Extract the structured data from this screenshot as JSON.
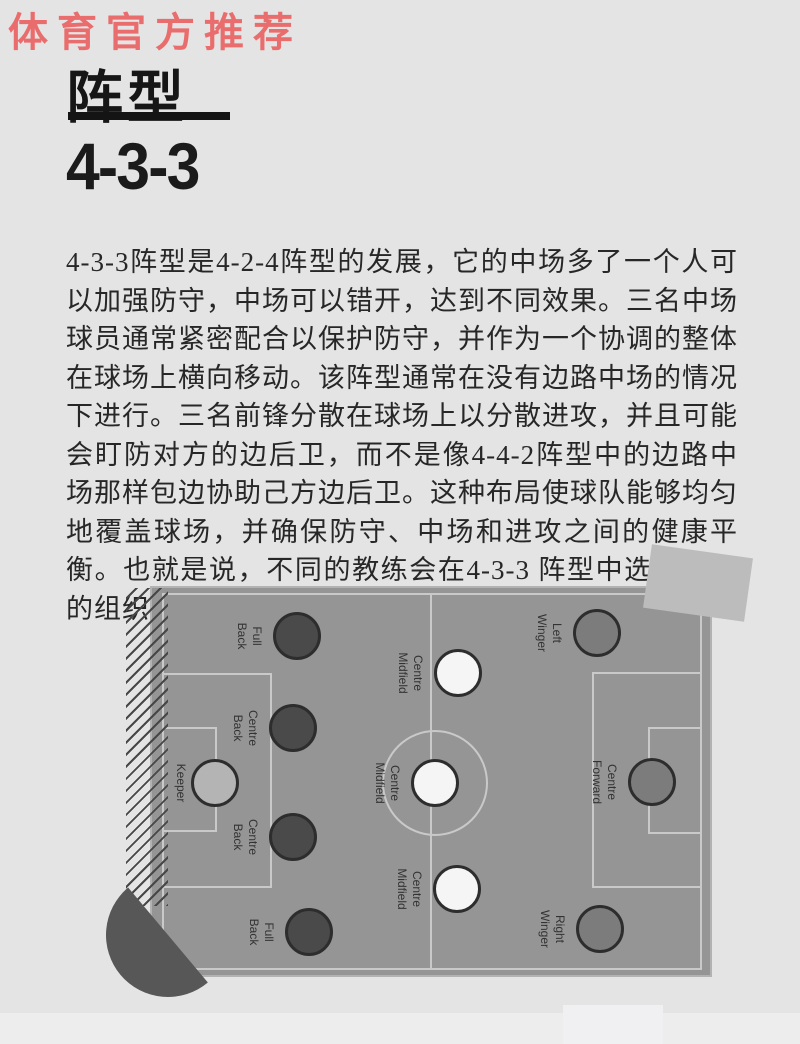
{
  "watermark": {
    "text": "体育官方推荐",
    "color": "#ea6d6d"
  },
  "header": {
    "title": "阵型",
    "subtitle": "4-3-3"
  },
  "article": {
    "text": "4-3-3阵型是4-2-4阵型的发展，它的中场多了一个人可以加强防守，中场可以错开，达到不同效果。三名中场球员通常紧密配合以保护防守，并作为一个协调的整体在球场上横向移动。该阵型通常在没有边路中场的情况下进行。三名前锋分散在球场上以分散进攻，并且可能会盯防对方的边后卫，而不是像4-4-2阵型中的边路中场那样包边协助己方边后卫。这种布局使球队能够均匀地覆盖球场，并确保防守、中场和进攻之间的健康平衡。也就是说，不同的教练会在4-3-3 阵型中选择不同的组织方式。"
  },
  "formation": {
    "name": "4-3-3",
    "role_colors": {
      "keeper": "#b4b4b4",
      "defender": "#4a4a4a",
      "midfielder": "#f5f5f5",
      "forward": "#7c7c7c"
    },
    "players": [
      {
        "label": "Keeper",
        "role": "keeper",
        "x": 215,
        "y": 783
      },
      {
        "label": "Full Back",
        "role": "defender",
        "x": 297,
        "y": 636
      },
      {
        "label": "Centre Back",
        "role": "defender",
        "x": 293,
        "y": 728
      },
      {
        "label": "Centre Back",
        "role": "defender",
        "x": 293,
        "y": 837
      },
      {
        "label": "Full Back",
        "role": "defender",
        "x": 309,
        "y": 932
      },
      {
        "label": "Centre Midfield",
        "role": "midfielder",
        "x": 458,
        "y": 673
      },
      {
        "label": "Centre Midfield",
        "role": "midfielder",
        "x": 435,
        "y": 783
      },
      {
        "label": "Centre Midfield",
        "role": "midfielder",
        "x": 457,
        "y": 889
      },
      {
        "label": "Left Winger",
        "role": "forward",
        "x": 597,
        "y": 633
      },
      {
        "label": "Centre Forward",
        "role": "forward",
        "x": 652,
        "y": 782
      },
      {
        "label": "Right Winger",
        "role": "forward",
        "x": 600,
        "y": 929
      }
    ]
  },
  "colors": {
    "page_background": "#e4e4e4",
    "pitch": "#959595",
    "pitch_lines": "#c9c9c9",
    "title_text": "#161616",
    "body_text": "#272727"
  }
}
